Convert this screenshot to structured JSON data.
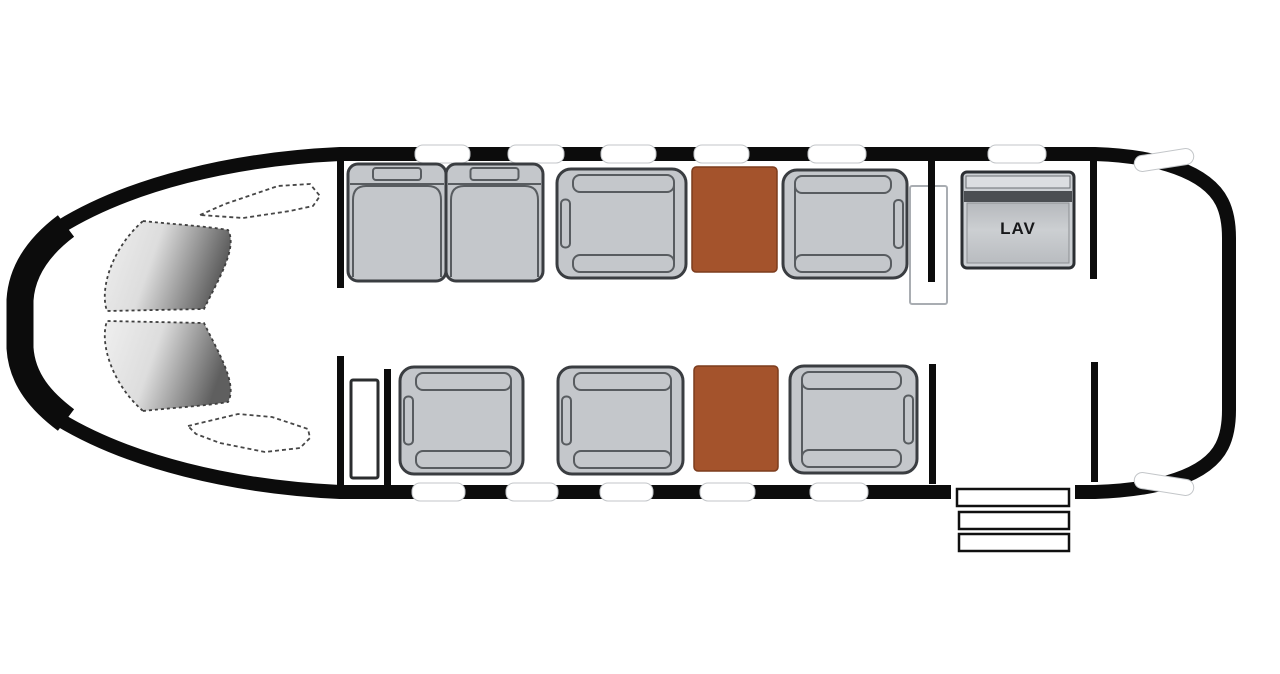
{
  "labels": {
    "lav": "LAV"
  },
  "colors": {
    "hull": "#0c0c0c",
    "seat_fill": "#c4c7cb",
    "seat_outline": "#3a3d41",
    "seat_inner": "#585c60",
    "table": "#a4532c",
    "lav_stripe": "#4b4e52",
    "window_fill": "#ffffff",
    "panel_outline": "#a9adb2"
  },
  "fixtures": {
    "windows": [
      {
        "x": 415,
        "y": 145,
        "w": 55,
        "h": 18
      },
      {
        "x": 508,
        "y": 145,
        "w": 56,
        "h": 18
      },
      {
        "x": 601,
        "y": 145,
        "w": 55,
        "h": 18
      },
      {
        "x": 694,
        "y": 145,
        "w": 55,
        "h": 18
      },
      {
        "x": 808,
        "y": 145,
        "w": 58,
        "h": 18
      },
      {
        "x": 988,
        "y": 145,
        "w": 58,
        "h": 18
      },
      {
        "x": 1134,
        "y": 152,
        "w": 60,
        "h": 16,
        "rot": -9
      },
      {
        "x": 412,
        "y": 483,
        "w": 53,
        "h": 18
      },
      {
        "x": 506,
        "y": 483,
        "w": 52,
        "h": 18
      },
      {
        "x": 600,
        "y": 483,
        "w": 53,
        "h": 18
      },
      {
        "x": 700,
        "y": 483,
        "w": 55,
        "h": 18
      },
      {
        "x": 810,
        "y": 483,
        "w": 58,
        "h": 18
      },
      {
        "x": 1134,
        "y": 476,
        "w": 60,
        "h": 16,
        "rot": 9
      }
    ],
    "seats": [
      {
        "id": "divan-seat-1",
        "type": "divan",
        "x": 348,
        "y": 164,
        "w": 98,
        "h": 117
      },
      {
        "id": "divan-seat-2",
        "type": "divan",
        "x": 446,
        "y": 164,
        "w": 97,
        "h": 117
      },
      {
        "id": "club-seat-fwd-top",
        "type": "club",
        "facing": "right",
        "x": 557,
        "y": 169,
        "w": 129,
        "h": 109
      },
      {
        "id": "club-seat-aft-top",
        "type": "club",
        "facing": "left",
        "x": 783,
        "y": 170,
        "w": 124,
        "h": 108
      },
      {
        "id": "club-seat-1-bottom",
        "type": "club",
        "facing": "right",
        "x": 400,
        "y": 367,
        "w": 123,
        "h": 107
      },
      {
        "id": "club-seat-2-bottom",
        "type": "club",
        "facing": "right",
        "x": 558,
        "y": 367,
        "w": 125,
        "h": 107
      },
      {
        "id": "club-seat-aft-bottom",
        "type": "club",
        "facing": "left",
        "x": 790,
        "y": 366,
        "w": 127,
        "h": 107
      }
    ],
    "tables": [
      {
        "x": 692,
        "y": 167,
        "w": 85,
        "h": 105
      },
      {
        "x": 694,
        "y": 366,
        "w": 84,
        "h": 105
      }
    ],
    "dividers": [
      {
        "x": 337,
        "y": 158,
        "w": 7,
        "h": 130
      },
      {
        "x": 337,
        "y": 356,
        "w": 7,
        "h": 130
      },
      {
        "x": 384,
        "y": 369,
        "w": 7,
        "h": 117
      },
      {
        "x": 928,
        "y": 158,
        "w": 7,
        "h": 124
      },
      {
        "x": 929,
        "y": 364,
        "w": 7,
        "h": 120
      },
      {
        "x": 1090,
        "y": 159,
        "w": 7,
        "h": 120
      },
      {
        "x": 1091,
        "y": 362,
        "w": 7,
        "h": 120
      }
    ],
    "panels": [
      {
        "name": "forward-closet",
        "x": 351,
        "y": 380,
        "w": 27,
        "h": 98,
        "stroke": "dark"
      },
      {
        "name": "cabin-door-panel",
        "x": 910,
        "y": 186,
        "w": 37,
        "h": 118,
        "stroke": "light"
      }
    ],
    "steps": [
      {
        "x": 957,
        "y": 489,
        "w": 112,
        "h": 17
      },
      {
        "x": 959,
        "y": 512,
        "w": 110,
        "h": 17
      },
      {
        "x": 959,
        "y": 534,
        "w": 110,
        "h": 17
      }
    ],
    "lav": {
      "x": 962,
      "y": 172,
      "w": 112,
      "h": 96
    }
  }
}
